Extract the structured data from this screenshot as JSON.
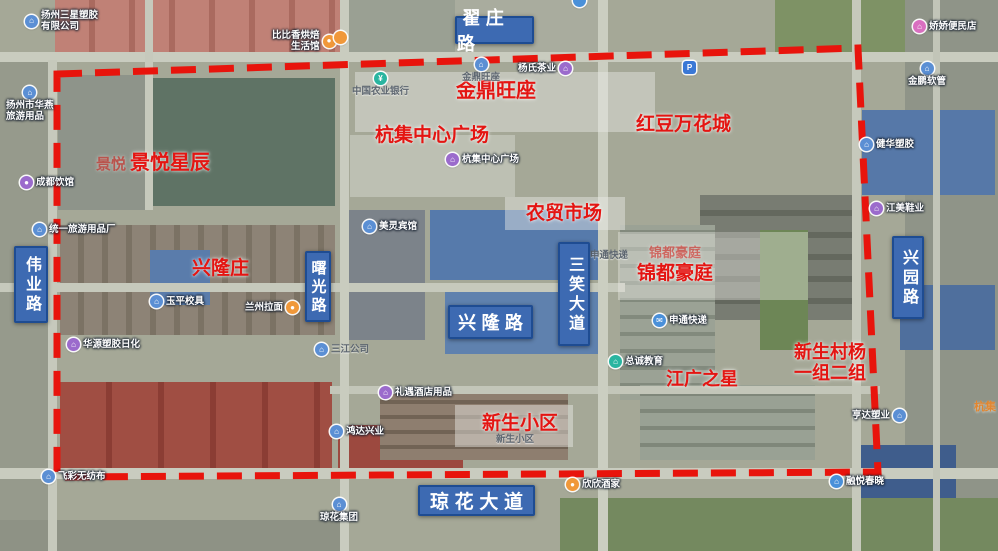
{
  "map": {
    "boundary_color": "#e8140c",
    "road_label_bg": "#3d6ab2",
    "road_label_border": "#1e4c92",
    "area_label_color": "#e41512"
  },
  "road_labels": [
    {
      "text": "翟庄路",
      "x": 455,
      "y": 16,
      "w": 79,
      "h": 28,
      "vertical": false,
      "fs": 18
    },
    {
      "text": "伟业路",
      "x": 14,
      "y": 246,
      "w": 34,
      "h": 77,
      "vertical": true,
      "fs": 16
    },
    {
      "text": "曙光路",
      "x": 305,
      "y": 251,
      "w": 26,
      "h": 71,
      "vertical": true,
      "fs": 15
    },
    {
      "text": "兴隆路",
      "x": 448,
      "y": 305,
      "w": 85,
      "h": 34,
      "vertical": false,
      "fs": 18
    },
    {
      "text": "三笑大道",
      "x": 558,
      "y": 242,
      "w": 32,
      "h": 104,
      "vertical": true,
      "fs": 16
    },
    {
      "text": "兴园路",
      "x": 892,
      "y": 236,
      "w": 32,
      "h": 83,
      "vertical": true,
      "fs": 16
    },
    {
      "text": "琼花大道",
      "x": 418,
      "y": 485,
      "w": 117,
      "h": 31,
      "vertical": false,
      "fs": 19
    }
  ],
  "area_labels": [
    {
      "text": "景悦",
      "x": 96,
      "y": 156,
      "fs": 15,
      "faint": true
    },
    {
      "text": "景悦星辰",
      "x": 130,
      "y": 152,
      "fs": 20
    },
    {
      "text": "金鼎旺座",
      "x": 456,
      "y": 80,
      "fs": 20
    },
    {
      "text": "杭集中心广场",
      "x": 375,
      "y": 125,
      "fs": 19
    },
    {
      "text": "红豆万花城",
      "x": 636,
      "y": 114,
      "fs": 19
    },
    {
      "text": "农贸市场",
      "x": 526,
      "y": 203,
      "fs": 19
    },
    {
      "text": "兴隆庄",
      "x": 192,
      "y": 258,
      "fs": 19
    },
    {
      "text": "锦都豪庭",
      "x": 649,
      "y": 245,
      "fs": 13,
      "faint": true
    },
    {
      "text": "锦都豪庭",
      "x": 637,
      "y": 263,
      "fs": 19
    },
    {
      "text": "江广之星",
      "x": 666,
      "y": 369,
      "fs": 18
    },
    {
      "text": "新生村杨\n一组二组",
      "x": 794,
      "y": 342,
      "fs": 18
    },
    {
      "text": "新生小区",
      "x": 482,
      "y": 413,
      "fs": 19
    }
  ],
  "poi_labels": [
    {
      "name": "poi-yangzhou-sanxing",
      "text": "扬州三星塑胶\n有限公司",
      "x": 25,
      "y": 10,
      "layout": "row",
      "icon": "building-icon",
      "icon_bg": "#5b8fd4",
      "glyph": "⌂"
    },
    {
      "name": "poi-bibixiang-bakery",
      "text": "比比香烘焙\n生活馆",
      "x": 272,
      "y": 30,
      "layout": "rev",
      "align": "right",
      "icon": "bakery-icon",
      "icon_bg": "#f0983a",
      "glyph": "●"
    },
    {
      "name": "poi-jiaojiao-store",
      "text": "娇娇便民店",
      "x": 913,
      "y": 20,
      "layout": "row",
      "icon": "store-icon",
      "icon_bg": "#d96fc0",
      "glyph": "⌂"
    },
    {
      "name": "poi-huayan-travel-goods",
      "text": "扬州市华燕\n旅游用品",
      "x": 6,
      "y": 86,
      "layout": "col",
      "icon": "building-icon",
      "icon_bg": "#5b8fd4",
      "glyph": "⌂"
    },
    {
      "name": "poi-chengdu-restaurant",
      "text": "成都饮馆",
      "x": 20,
      "y": 176,
      "layout": "row",
      "icon": "restaurant-icon",
      "icon_bg": "#9b6bcc",
      "glyph": "●"
    },
    {
      "name": "poi-jinpeng-hose",
      "text": "金鹏软管",
      "x": 908,
      "y": 62,
      "layout": "col",
      "icon": "building-icon",
      "icon_bg": "#5b8fd4",
      "glyph": "⌂"
    },
    {
      "name": "poi-jianhua-plastics",
      "text": "健华塑胶",
      "x": 860,
      "y": 138,
      "layout": "row",
      "icon": "building-icon",
      "icon_bg": "#5b8fd4",
      "glyph": "⌂"
    },
    {
      "name": "poi-abc-bank",
      "text": "中国农业银行",
      "x": 352,
      "y": 72,
      "layout": "col",
      "muted": true,
      "icon": "bank-icon",
      "icon_bg": "#2ab5a0",
      "glyph": "¥"
    },
    {
      "name": "poi-jinding-wangzuo",
      "text": "金鼎旺座",
      "x": 462,
      "y": 58,
      "layout": "col",
      "muted": true,
      "icon": "building-icon",
      "icon_bg": "#5b8fd4",
      "glyph": "⌂"
    },
    {
      "name": "poi-yangshi-tea",
      "text": "杨氏茶业",
      "x": 518,
      "y": 62,
      "layout": "rev",
      "icon": "shop-icon",
      "icon_bg": "#9b6bcc",
      "glyph": "⌂"
    },
    {
      "name": "poi-hangji-plaza",
      "text": "杭集中心广场",
      "x": 446,
      "y": 153,
      "layout": "row",
      "icon": "plaza-icon",
      "icon_bg": "#9b6bcc",
      "glyph": "⌂"
    },
    {
      "name": "poi-tongyi-travel-factory",
      "text": "统一旅游用品厂",
      "x": 33,
      "y": 223,
      "layout": "row",
      "icon": "building-icon",
      "icon_bg": "#5b8fd4",
      "glyph": "⌂"
    },
    {
      "name": "poi-yuping-school-furniture",
      "text": "玉平校具",
      "x": 150,
      "y": 295,
      "layout": "row",
      "icon": "building-icon",
      "icon_bg": "#5b8fd4",
      "glyph": "⌂"
    },
    {
      "name": "poi-lanzhou-noodles",
      "text": "兰州拉面",
      "x": 245,
      "y": 301,
      "layout": "rev",
      "icon": "restaurant-icon",
      "icon_bg": "#f0983a",
      "glyph": "●"
    },
    {
      "name": "poi-huayuan-daily-chem",
      "text": "华源塑胶日化",
      "x": 67,
      "y": 338,
      "layout": "row",
      "icon": "building-icon",
      "icon_bg": "#9b6bcc",
      "glyph": "⌂"
    },
    {
      "name": "poi-meiling-hotel",
      "text": "美灵宾馆",
      "x": 363,
      "y": 220,
      "layout": "row",
      "icon": "hotel-icon",
      "icon_bg": "#5b8fd4",
      "glyph": "⌂"
    },
    {
      "name": "poi-shentong-express-1",
      "text": "申通快递",
      "x": 590,
      "y": 250,
      "layout": "row",
      "muted": true
    },
    {
      "name": "poi-sanjiang-company",
      "text": "三江公司",
      "x": 315,
      "y": 343,
      "layout": "row",
      "muted": true,
      "icon": "building-icon",
      "icon_bg": "#5b8fd4",
      "glyph": "⌂"
    },
    {
      "name": "poi-shentong-express-2",
      "text": "申通快递",
      "x": 653,
      "y": 314,
      "layout": "row",
      "icon": "express-icon",
      "icon_bg": "#4a90d9",
      "glyph": "✉"
    },
    {
      "name": "poi-zongcheng-education",
      "text": "总诚教育",
      "x": 609,
      "y": 355,
      "layout": "row",
      "icon": "education-icon",
      "icon_bg": "#2ab5a0",
      "glyph": "⌂"
    },
    {
      "name": "poi-jiangmei-shoes",
      "text": "江美鞋业",
      "x": 870,
      "y": 202,
      "layout": "row",
      "icon": "shop-icon",
      "icon_bg": "#9b6bcc",
      "glyph": "⌂"
    },
    {
      "name": "poi-liyu-hotel-supplies",
      "text": "礼遇酒店用品",
      "x": 379,
      "y": 386,
      "layout": "row",
      "icon": "shop-icon",
      "icon_bg": "#9b6bcc",
      "glyph": "⌂"
    },
    {
      "name": "poi-hongda-xingye",
      "text": "鸿达兴业",
      "x": 330,
      "y": 425,
      "layout": "row",
      "icon": "building-icon",
      "icon_bg": "#5b8fd4",
      "glyph": "⌂"
    },
    {
      "name": "poi-xinsheng-community",
      "text": "新生小区",
      "x": 496,
      "y": 434,
      "layout": "row",
      "muted": true
    },
    {
      "name": "poi-xinxin-restaurant",
      "text": "欣欣酒家",
      "x": 566,
      "y": 478,
      "layout": "row",
      "icon": "restaurant-icon",
      "icon_bg": "#f0983a",
      "glyph": "●"
    },
    {
      "name": "poi-qionghua-group",
      "text": "琼花集团",
      "x": 320,
      "y": 498,
      "layout": "col",
      "icon": "building-icon",
      "icon_bg": "#5b8fd4",
      "glyph": "⌂"
    },
    {
      "name": "poi-feicai-nonwoven",
      "text": "飞彩无纺布",
      "x": 42,
      "y": 470,
      "layout": "row",
      "icon": "building-icon",
      "icon_bg": "#5b8fd4",
      "glyph": "⌂"
    },
    {
      "name": "poi-hengda-suye",
      "text": "亨达塑业",
      "x": 852,
      "y": 409,
      "layout": "rev",
      "icon": "building-icon",
      "icon_bg": "#5b8fd4",
      "glyph": "⌂"
    },
    {
      "name": "poi-rongyue-chunxiao",
      "text": "融悦春晓",
      "x": 830,
      "y": 475,
      "layout": "row",
      "icon": "residence-icon",
      "icon_bg": "#4a90d9",
      "glyph": "⌂"
    },
    {
      "name": "poi-parking",
      "text": "",
      "x": 683,
      "y": 61,
      "layout": "row",
      "icon": "parking-icon",
      "icon_bg": "#3a78d6",
      "glyph": "P",
      "square": true
    },
    {
      "name": "poi-hangji-town",
      "text": "杭集",
      "x": 974,
      "y": 401,
      "layout": "row",
      "orange": true
    },
    {
      "name": "poi-map-pin-top",
      "text": "",
      "x": 573,
      "y": -6,
      "layout": "row",
      "icon": "map-pin-icon",
      "icon_bg": "#4a90d9",
      "glyph": ""
    },
    {
      "name": "poi-orange-dot",
      "text": "",
      "x": 334,
      "y": 31,
      "layout": "row",
      "icon": "poi-dot-icon",
      "icon_bg": "#f0983a",
      "glyph": ""
    }
  ]
}
